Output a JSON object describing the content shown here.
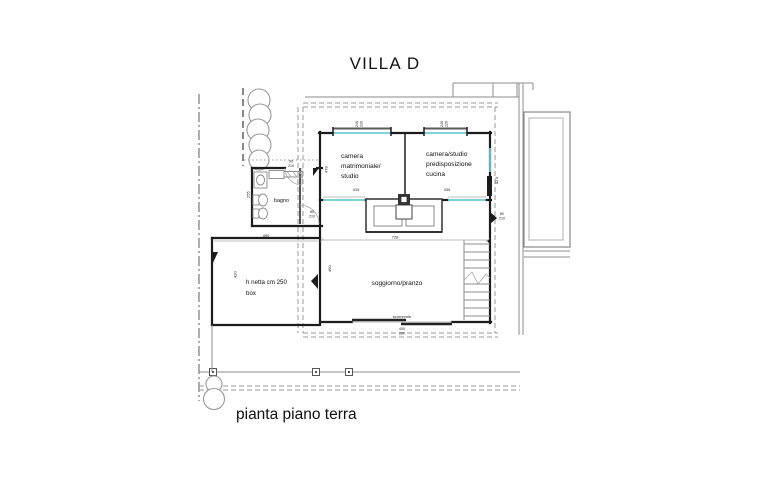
{
  "title": "VILLA D",
  "caption": "pianta piano terra",
  "rooms": {
    "bedroom1": {
      "l1": "camera",
      "l2": "matrimoniale/",
      "l3": "studio"
    },
    "bedroom2": {
      "l1": "camera/studio",
      "l2": "predisposizione",
      "l3": "cucina"
    },
    "bathroom": {
      "label": "bagno"
    },
    "living": {
      "label": "soggiorno/pranzo"
    },
    "garage": {
      "l1": "h netta cm 250",
      "l2": "box"
    }
  },
  "labels": {
    "sliding_door": "scorrevole"
  },
  "dims": {
    "window_left_w": "240",
    "window_left_h": "220",
    "window_right_w": "240",
    "window_right_h": "220",
    "bedroom1_width": "415",
    "bedroom1_depth": "478",
    "bedroom2_width": "435",
    "living_width": "728",
    "living_depth": "460",
    "garage_width": "490",
    "garage_depth": "420",
    "bath_side": "255",
    "bath_door_w": "80",
    "bath_door_h": "210",
    "entry_door_w": "90",
    "entry_door_h": "210",
    "right_door_w": "80",
    "right_door_h": "210",
    "right_side": "82.5",
    "sliding_w": "400",
    "sliding_h": "220"
  },
  "colors": {
    "wall": "#1c1c1c",
    "thin_line": "#8d8d8d",
    "window": "#6fc9d4",
    "boundary": "#9a9a9a",
    "text": "#111111"
  }
}
